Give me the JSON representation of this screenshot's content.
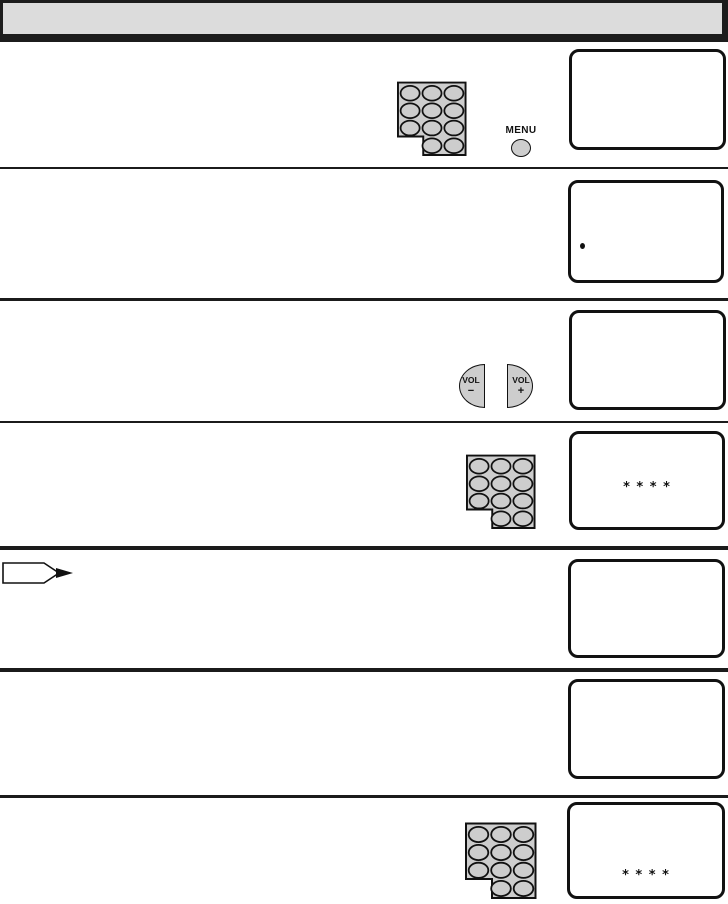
{
  "colors": {
    "header_fill": "#dcdcdc",
    "frame_black": "#1b1b1b",
    "button_gray": "#cdcdcd",
    "screen_border": "#111111"
  },
  "controls": {
    "menu": {
      "label": "MENU"
    },
    "volume_down": {
      "label": "VOL",
      "sign": "−"
    },
    "volume_up": {
      "label": "VOL",
      "sign": "+"
    }
  },
  "screens": {
    "step1": {
      "content": ""
    },
    "step2": {
      "content": "",
      "has_bullet": true
    },
    "step3": {
      "content": ""
    },
    "step4": {
      "code": "* * * *"
    },
    "step5": {
      "content": ""
    },
    "step6": {
      "content": ""
    },
    "step7": {
      "code": "* * * *"
    }
  },
  "icons": {
    "keypad": "numeric-keypad-icon",
    "menu": "menu-button-icon",
    "volume_down": "volume-down-button-icon",
    "volume_up": "volume-up-button-icon",
    "note": "note-pointer-icon",
    "bullet": "bullet-dot-icon"
  }
}
